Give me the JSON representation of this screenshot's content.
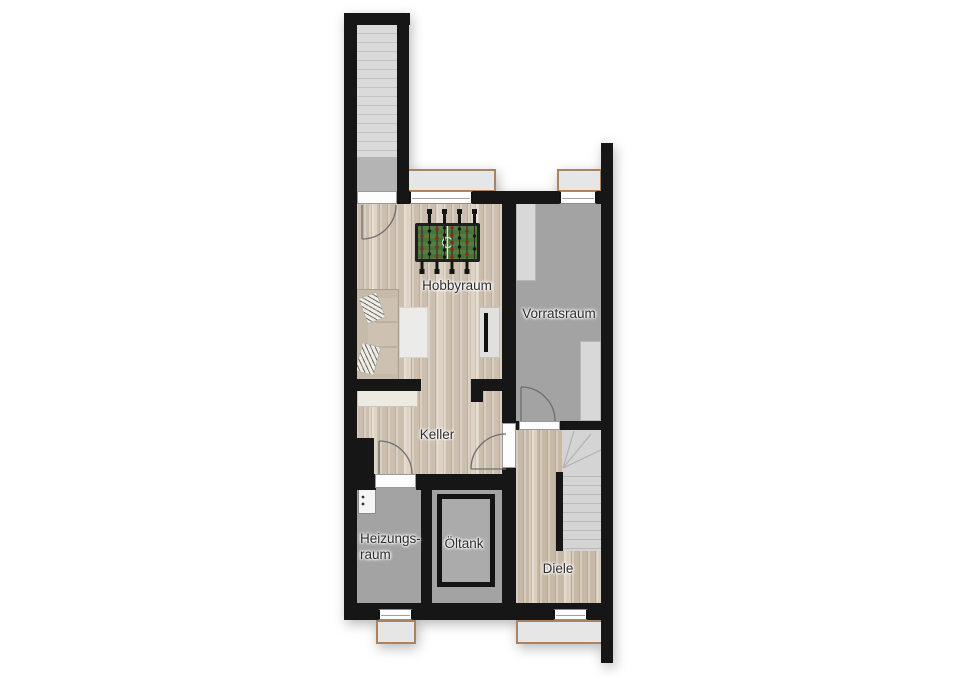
{
  "floorplan": {
    "rooms": {
      "hobbyraum": {
        "label": "Hobbyraum"
      },
      "vorratsraum": {
        "label": "Vorratsraum"
      },
      "keller": {
        "label": "Keller"
      },
      "heizungsraum": {
        "label": "Heizungs-\nraum"
      },
      "oeltank": {
        "label": "Öltank"
      },
      "diele": {
        "label": "Diele"
      }
    },
    "colors": {
      "wall": "#161616",
      "wood_floor": "#d5cabc",
      "concrete_floor": "#a3a3a3",
      "stair_tread": "#d4d4d4",
      "window_frame": "#ffffff",
      "lightwell_border": "#ab835e",
      "foosball_field_green": "#4f7a3c",
      "player_red": "#8f2420",
      "label_text": "#2e2e2e"
    },
    "objects": [
      "exterior-stairs",
      "interior-stairs",
      "foosball-table",
      "sofa",
      "pillows",
      "rug",
      "sideboard",
      "tv",
      "storage-shelves",
      "workbench",
      "boiler",
      "oil-tank",
      "chimney",
      "light-wells",
      "windows",
      "doors"
    ]
  }
}
